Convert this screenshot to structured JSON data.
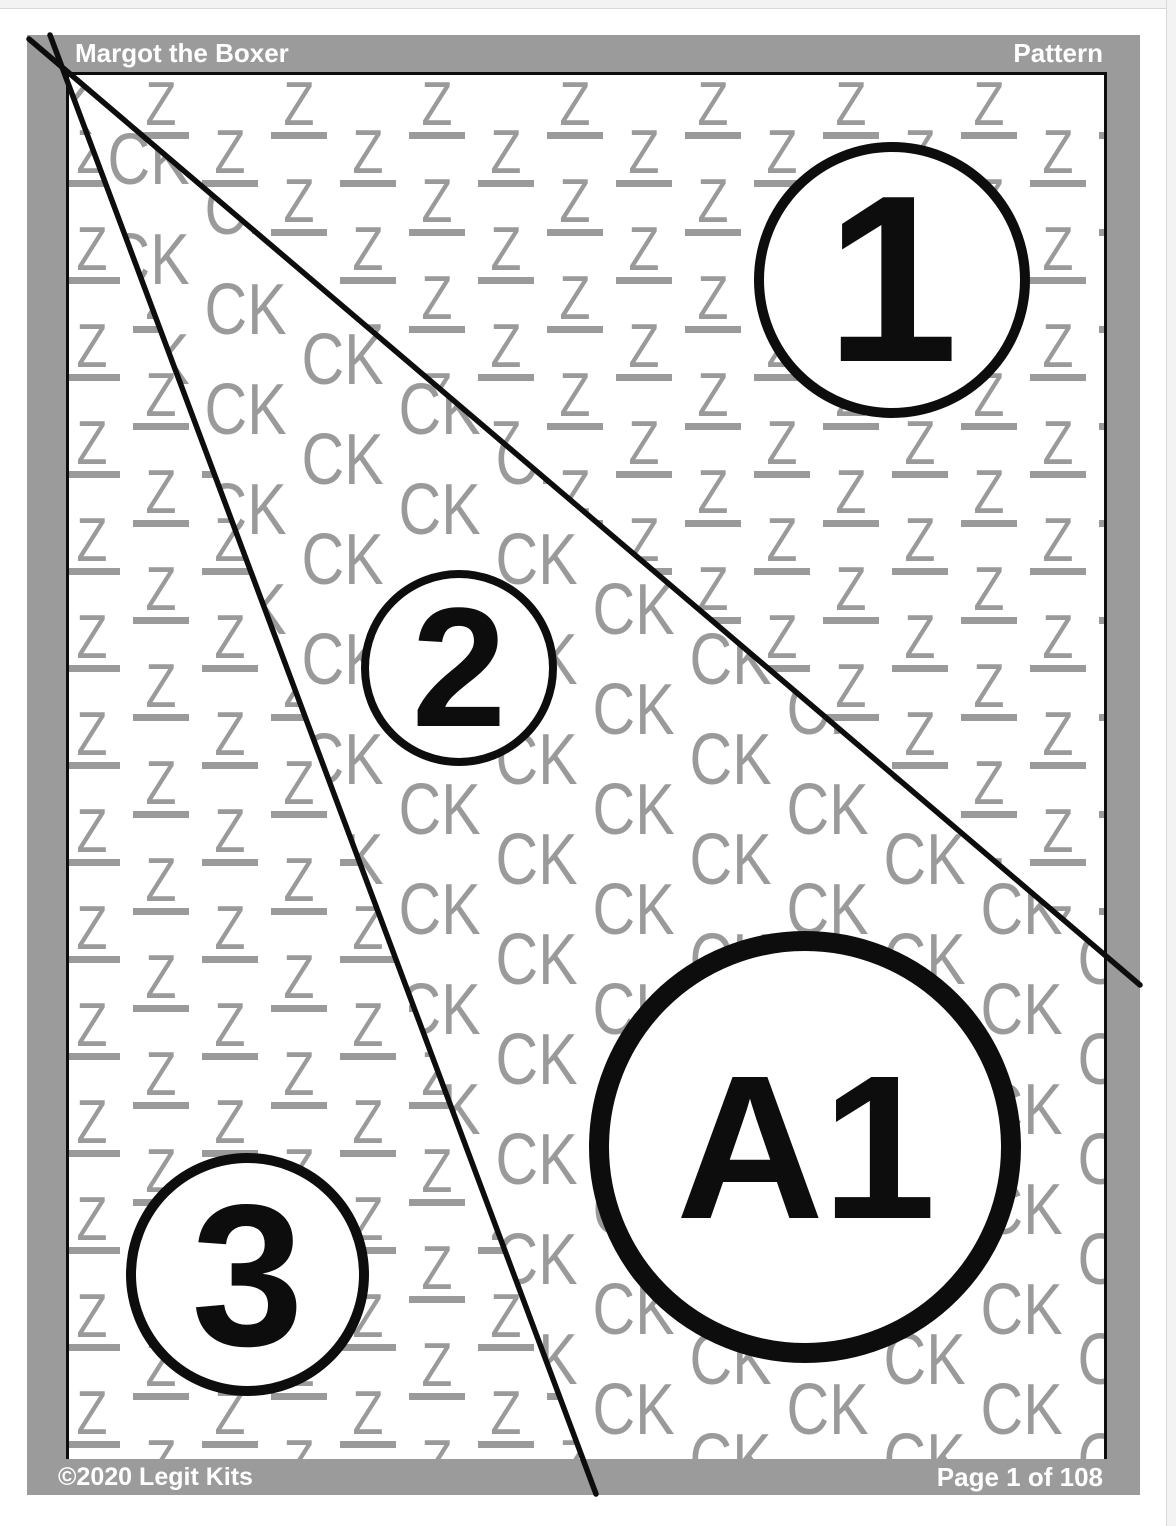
{
  "header": {
    "title": "Margot the Boxer",
    "right_label": "Pattern"
  },
  "footer": {
    "copyright": "©2020",
    "brand": "Legit Kits",
    "page_info": "Page 1 of 108"
  },
  "watermark": {
    "zone_z_code": "Z",
    "zone_ck_code": "CK"
  },
  "pieces": {
    "p1": "1",
    "p2": "2",
    "p3": "3",
    "section": "A1"
  },
  "colors": {
    "frame_gray": "#9b9b9b",
    "watermark_gray": "#9a9a9a",
    "line_black": "#0d0d0d"
  },
  "pattern_geometry": {
    "seam_lines": [
      {
        "x1": 50,
        "y1": 35,
        "x2": 596,
        "y2": 1494
      },
      {
        "x1": 29,
        "y1": 39,
        "x2": 1140,
        "y2": 985
      }
    ]
  }
}
